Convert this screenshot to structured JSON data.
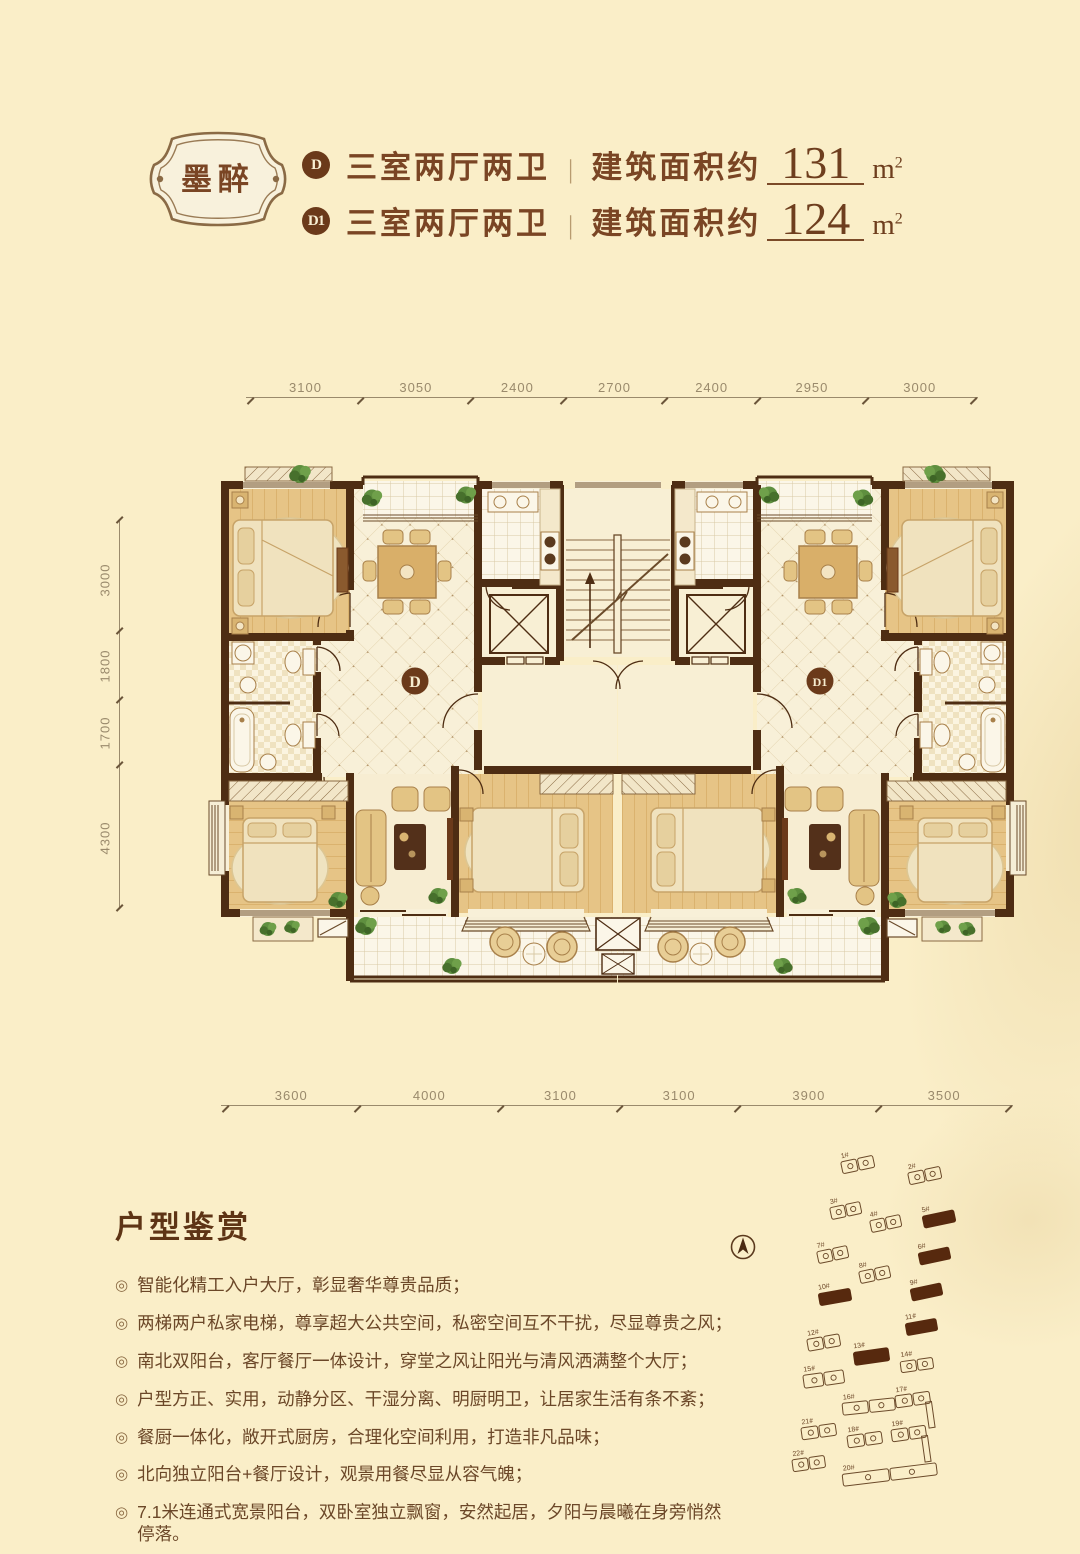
{
  "page": {
    "background": "#FAEEC8",
    "accent": "#7A4524",
    "wall_color": "#4E2D13"
  },
  "header": {
    "badge_text": "墨醉",
    "units": [
      {
        "tag": "D",
        "layout": "三室两厅两卫",
        "divider": "|",
        "area_label": "建筑面积约",
        "area_value": "131",
        "area_unit_base": "m",
        "area_unit_sup": "2"
      },
      {
        "tag": "D1",
        "layout": "三室两厅两卫",
        "divider": "|",
        "area_label": "建筑面积约",
        "area_value": "124",
        "area_unit_base": "m",
        "area_unit_sup": "2"
      }
    ]
  },
  "floorplan": {
    "unit_label_d": "D",
    "unit_label_d1": "D1",
    "dims_top": [
      "3100",
      "3050",
      "2400",
      "2700",
      "2400",
      "2950",
      "3000"
    ],
    "dims_left": [
      "3000",
      "1800",
      "1700",
      "4300"
    ],
    "dims_bottom": [
      "3600",
      "4000",
      "3100",
      "3100",
      "3900",
      "3500"
    ]
  },
  "features": {
    "title": "户型鉴赏",
    "bullet_icon": "◎",
    "bullets": [
      "智能化精工入户大厅，彰显奢华尊贵品质；",
      "两梯两户私家电梯，尊享超大公共空间，私密空间互不干扰，尽显尊贵之风；",
      "南北双阳台，客厅餐厅一体设计，穿堂之风让阳光与清风洒满整个大厅；",
      "户型方正、实用，动静分区、干湿分离、明厨明卫，让居家生活有条不紊；",
      "餐厨一体化，敞开式厨房，合理化空间利用，打造非凡品味；",
      "北向独立阳台+餐厅设计，观景用餐尽显从容气魄；",
      "7.1米连通式宽景阳台，双卧室独立飘窗，安然起居，夕阳与晨曦在身旁悄然停落。"
    ]
  },
  "siteplan": {
    "compass": "north-arrow",
    "buildings": [
      {
        "label": "1#",
        "x": 71,
        "y": 8,
        "w": 34,
        "h": 13,
        "rot": -12,
        "filled": false
      },
      {
        "label": "2#",
        "x": 138,
        "y": 19,
        "w": 34,
        "h": 13,
        "rot": -12,
        "filled": false
      },
      {
        "label": "3#",
        "x": 60,
        "y": 54,
        "w": 32,
        "h": 13,
        "rot": -12,
        "filled": false
      },
      {
        "label": "4#",
        "x": 100,
        "y": 67,
        "w": 32,
        "h": 13,
        "rot": -12,
        "filled": false
      },
      {
        "label": "5#",
        "x": 152,
        "y": 62,
        "w": 34,
        "h": 14,
        "rot": -12,
        "filled": true
      },
      {
        "label": "7#",
        "x": 47,
        "y": 98,
        "w": 32,
        "h": 13,
        "rot": -12,
        "filled": false
      },
      {
        "label": "6#",
        "x": 148,
        "y": 99,
        "w": 33,
        "h": 14,
        "rot": -12,
        "filled": true
      },
      {
        "label": "8#",
        "x": 89,
        "y": 118,
        "w": 32,
        "h": 13,
        "rot": -12,
        "filled": false
      },
      {
        "label": "9#",
        "x": 140,
        "y": 135,
        "w": 33,
        "h": 14,
        "rot": -12,
        "filled": true
      },
      {
        "label": "10#",
        "x": 48,
        "y": 140,
        "w": 34,
        "h": 14,
        "rot": -10,
        "filled": true
      },
      {
        "label": "11#",
        "x": 135,
        "y": 170,
        "w": 33,
        "h": 14,
        "rot": -10,
        "filled": true
      },
      {
        "label": "12#",
        "x": 37,
        "y": 186,
        "w": 34,
        "h": 13,
        "rot": -10,
        "filled": false
      },
      {
        "label": "13#",
        "x": 83,
        "y": 199,
        "w": 37,
        "h": 15,
        "rot": -8,
        "filled": true
      },
      {
        "label": "14#",
        "x": 130,
        "y": 208,
        "w": 34,
        "h": 12,
        "rot": -8,
        "filled": false
      },
      {
        "label": "15#",
        "x": 33,
        "y": 222,
        "w": 42,
        "h": 14,
        "rot": -8,
        "filled": false
      },
      {
        "label": "16#",
        "x": 72,
        "y": 250,
        "w": 54,
        "h": 13,
        "rot": -6,
        "filled": false
      },
      {
        "label": "17#",
        "x": 125,
        "y": 243,
        "w": 36,
        "h": 13,
        "rot": -8,
        "filled": false,
        "wing": true
      },
      {
        "label": "21#",
        "x": 31,
        "y": 275,
        "w": 36,
        "h": 13,
        "rot": -8,
        "filled": false
      },
      {
        "label": "18#",
        "x": 77,
        "y": 283,
        "w": 36,
        "h": 13,
        "rot": -8,
        "filled": false
      },
      {
        "label": "19#",
        "x": 121,
        "y": 277,
        "w": 36,
        "h": 13,
        "rot": -8,
        "filled": false,
        "wing": true
      },
      {
        "label": "22#",
        "x": 22,
        "y": 307,
        "w": 34,
        "h": 13,
        "rot": -8,
        "filled": false
      },
      {
        "label": "20#",
        "x": 72,
        "y": 318,
        "w": 96,
        "h": 13,
        "rot": -7,
        "filled": false
      }
    ]
  }
}
